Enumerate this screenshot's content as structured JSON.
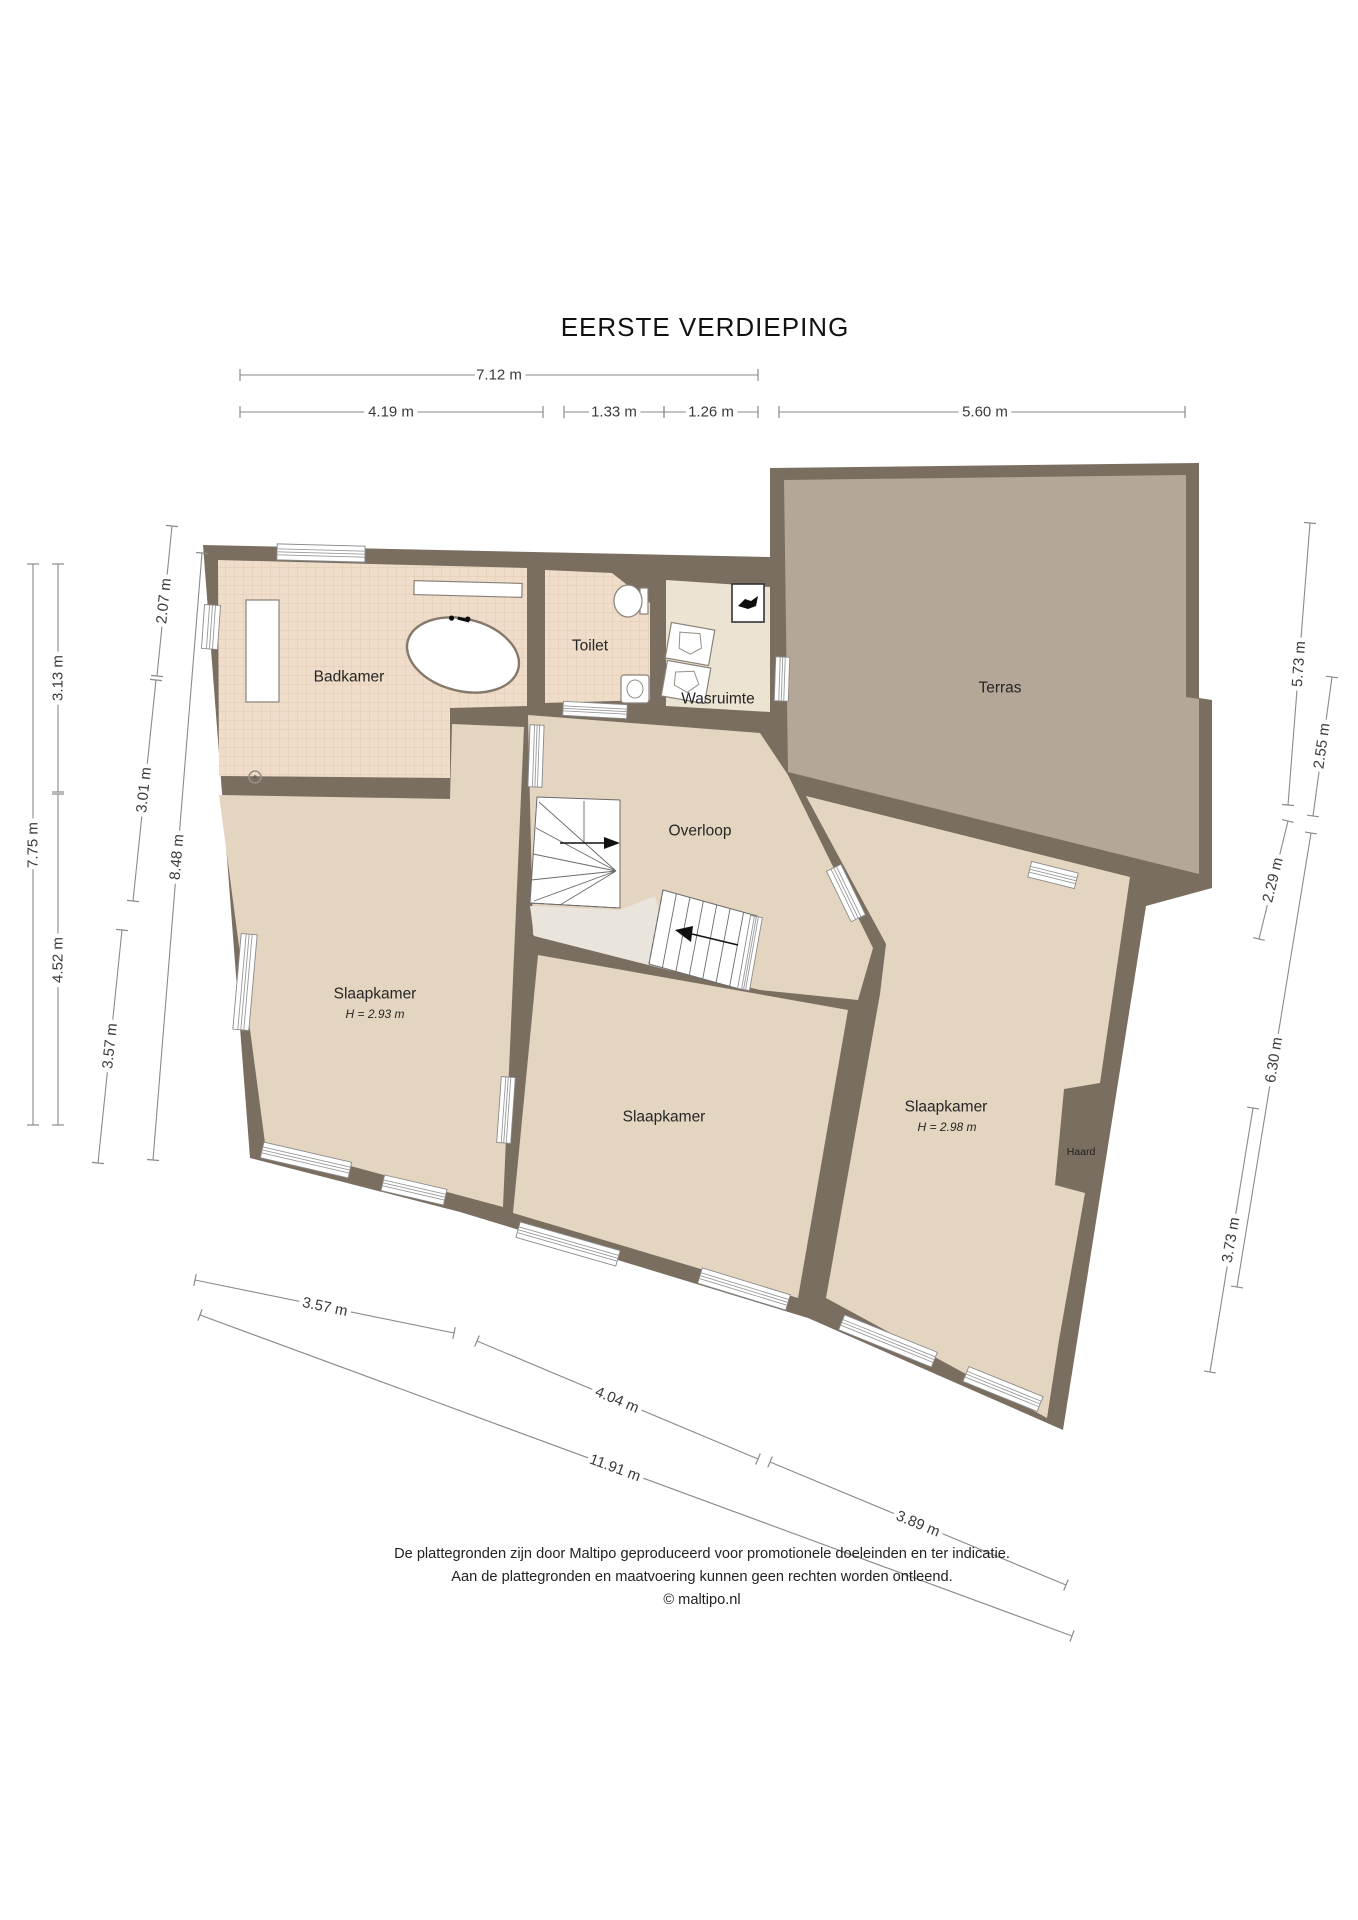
{
  "title": "EERSTE VERDIEPING",
  "rooms": {
    "badkamer": "Badkamer",
    "toilet": "Toilet",
    "wasruimte": "Wasruimte",
    "terras": "Terras",
    "overloop": "Overloop",
    "slaapkamer_links": {
      "label": "Slaapkamer",
      "height": "H = 2.93 m"
    },
    "slaapkamer_midden": {
      "label": "Slaapkamer"
    },
    "slaapkamer_rechts": {
      "label": "Slaapkamer",
      "height": "H = 2.98 m"
    },
    "haard": "Haard"
  },
  "dimensions": {
    "top": [
      "7.12 m",
      "4.19 m",
      "1.33 m",
      "1.26 m",
      "5.60 m"
    ],
    "left": [
      "7.75 m",
      "3.13 m",
      "4.52 m",
      "2.07 m",
      "3.01 m",
      "3.57 m",
      "8.48 m"
    ],
    "right": [
      "5.73 m",
      "2.55 m",
      "2.29 m",
      "6.30 m",
      "3.73 m"
    ],
    "bottom": [
      "3.57 m",
      "4.04 m",
      "11.91 m",
      "3.89 m"
    ]
  },
  "footer": {
    "line1": "De plattegronden zijn door Maltipo geproduceerd voor promotionele doeleinden en ter indicatie.",
    "line2": "Aan de plattegronden en maatvoering kunnen geen rechten worden ontleend.",
    "line3": "© maltipo.nl"
  },
  "colors": {
    "wall": "#7a6e61",
    "floor": "#e4d5c1",
    "tile": "#efddc9",
    "tile_line": "#dcc6ae",
    "utility": "#ece4d3",
    "terrace": "#b5a798",
    "void": "#e9e5dc",
    "dim": "#8a8a8a"
  }
}
